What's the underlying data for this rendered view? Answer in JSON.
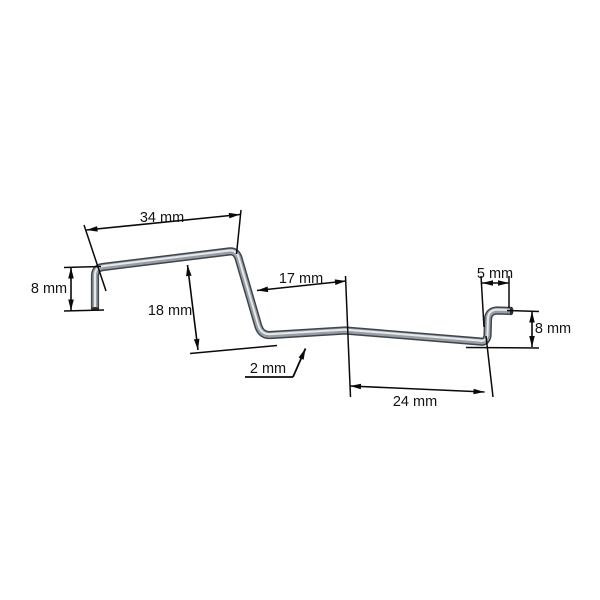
{
  "drawing": {
    "unit": "mm",
    "dimensions": {
      "top_length": {
        "label": "34 mm",
        "value": 34
      },
      "left_height": {
        "label": "8 mm",
        "value": 8
      },
      "mid_height": {
        "label": "18 mm",
        "value": 18
      },
      "mid_length": {
        "label": "17 mm",
        "value": 17
      },
      "wire_diameter": {
        "label": "2 mm",
        "value": 2
      },
      "right_top_length": {
        "label": "5 mm",
        "value": 5
      },
      "right_height": {
        "label": "8 mm",
        "value": 8
      },
      "bottom_length": {
        "label": "24 mm",
        "value": 24
      }
    },
    "colors": {
      "background": "#ffffff",
      "dimension_line": "#0a0a0a",
      "wire_dark": "#41464d",
      "wire_mid": "#979ea6",
      "wire_highlight": "#e7e9eb",
      "wire_end": "#2a2e33"
    }
  }
}
